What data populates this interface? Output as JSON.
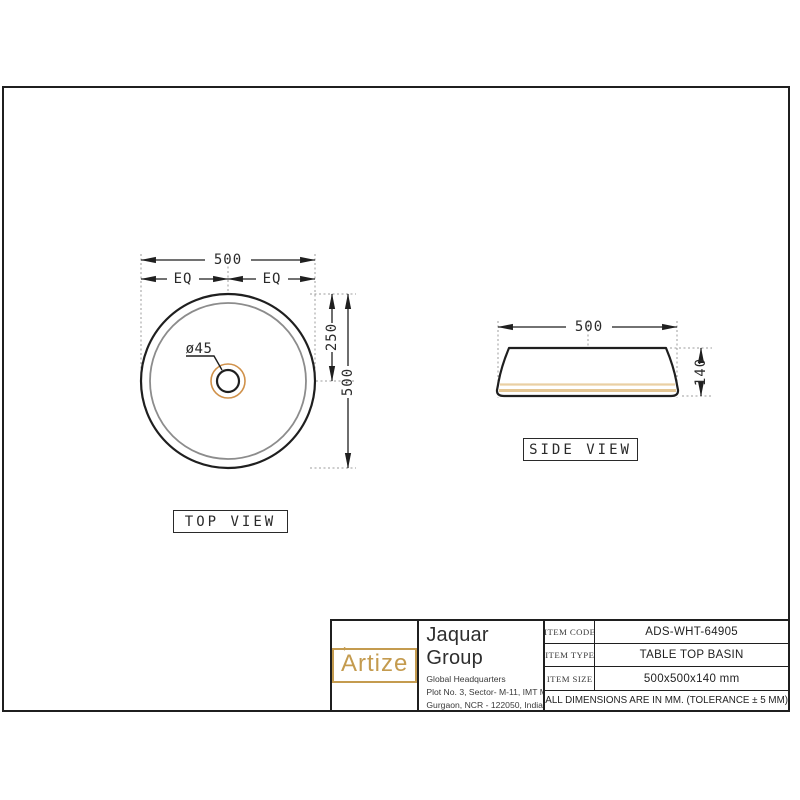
{
  "drawing": {
    "top_view": {
      "label": "TOP VIEW",
      "dim_width": "500",
      "dim_eq_left": "EQ",
      "dim_eq_right": "EQ",
      "dim_drain": "ø45",
      "dim_half": "250",
      "dim_height": "500"
    },
    "side_view": {
      "label": "SIDE VIEW",
      "dim_width": "500",
      "dim_height": "140"
    }
  },
  "title_block": {
    "logo_text": "Artize",
    "logo_accent": "ʼ",
    "company": "Jaquar Group",
    "address_lines": [
      "Global Headquarters",
      "Plot No. 3, Sector- M-11, IMT Manesar",
      "Gurgaon, NCR - 122050, India"
    ],
    "email_label": "E-mail : ",
    "email_value": "Sales: support@jaquar.com",
    "service_label": "Customer Service : ",
    "service_value": "service@jaquar.com",
    "rows": [
      {
        "label": "ITEM CODE",
        "value": "ADS-WHT-64905"
      },
      {
        "label": "ITEM TYPE",
        "value": "TABLE TOP BASIN"
      },
      {
        "label": "ITEM SIZE",
        "value": "500x500x140 mm"
      }
    ],
    "note": "ALL DIMENSIONS ARE IN MM. (TOLERANCE ± 5 MM)"
  },
  "colors": {
    "line": "#1f1f1f",
    "inner_gray": "#8c8c8c",
    "dotted_gray": "#9c9c9c",
    "accent_gold": "#c49b4f",
    "orange_ring": "#d0914a",
    "tan_band": "#ead0a4"
  }
}
